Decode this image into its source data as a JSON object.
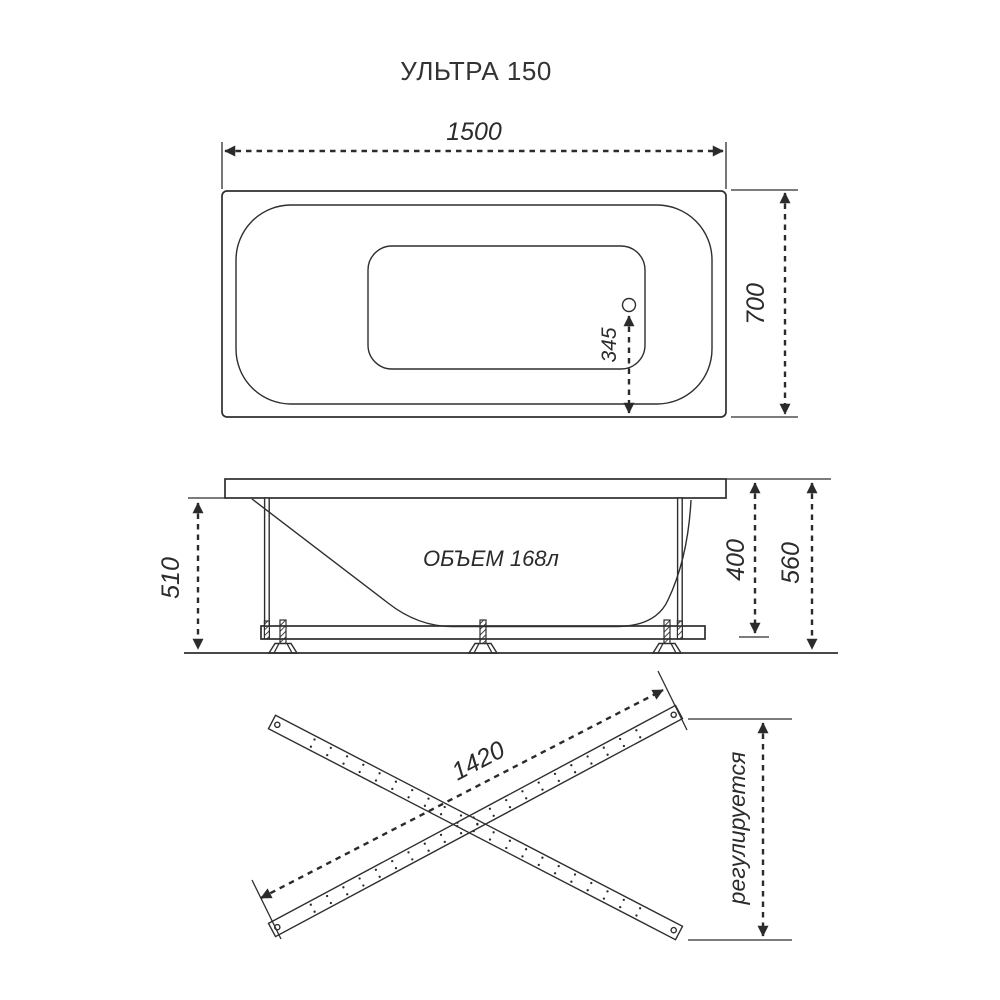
{
  "title": "УЛЬТРА 150",
  "colors": {
    "background": "#ffffff",
    "line": "#2e2e2e",
    "text": "#2b2b2b"
  },
  "top_view": {
    "length_mm": "1500",
    "width_mm": "700",
    "drain_offset_mm": "345"
  },
  "side_view": {
    "volume": "ОБЪЕМ 168л",
    "rim_to_floor_mm": "510",
    "rim_to_frame_mm": "400",
    "total_height_mm": "560"
  },
  "frame_view": {
    "rail_length_mm": "1420",
    "adjustable": "регулируется"
  }
}
